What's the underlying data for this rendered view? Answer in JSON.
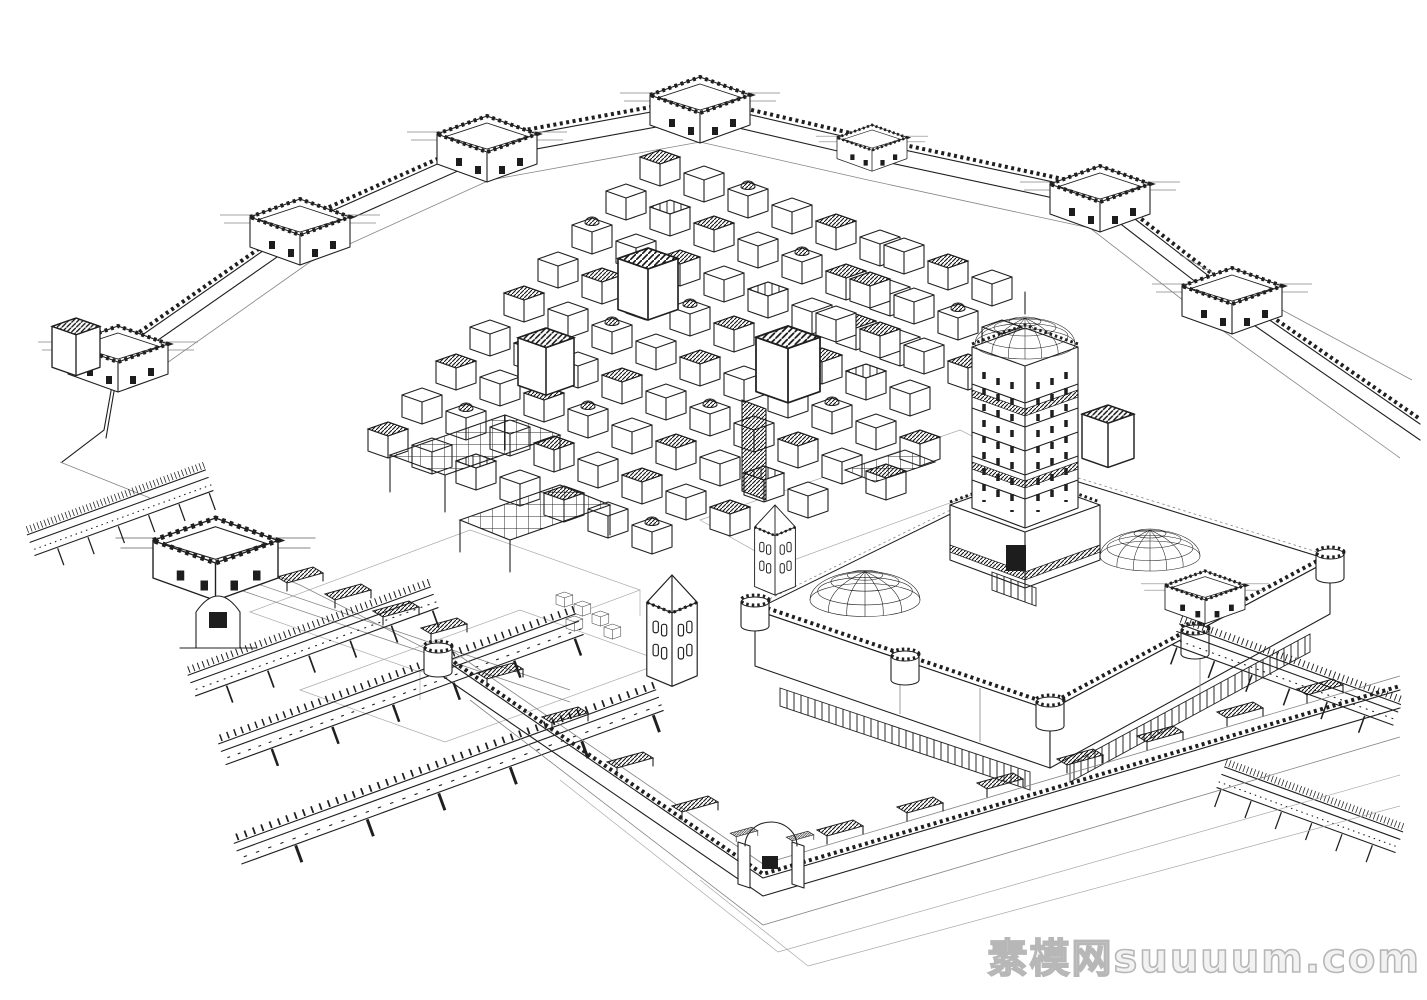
{
  "canvas": {
    "background": "#ffffff",
    "ink": "#1f1f1f"
  },
  "scene_label": "wireframe line-art 3d model of a fortified walled city",
  "watermark": {
    "text": "素模网suuuum.com",
    "color": "#b7b7b7"
  }
}
